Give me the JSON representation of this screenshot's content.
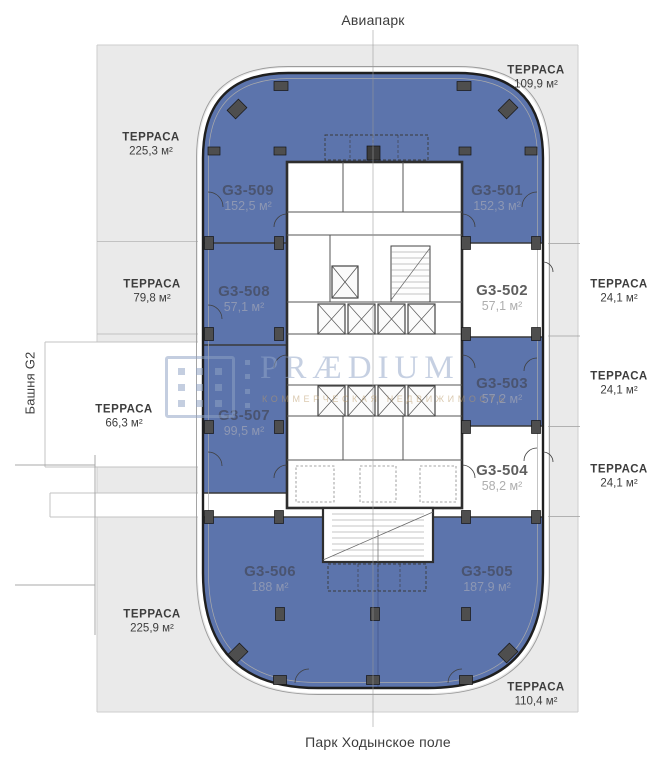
{
  "surroundings": {
    "top": "Авиапарк",
    "bottom": "Парк Ходынское поле",
    "left": "Башня G2"
  },
  "watermark": {
    "brand": "PRÆDIUM",
    "tagline": "КОММЕРЧЕСКАЯ НЕДВИЖИМОСТЬ"
  },
  "terraces": [
    {
      "name": "ТЕРРАСА",
      "area": "225,3 м²",
      "position": "top-left"
    },
    {
      "name": "ТЕРРАСА",
      "area": "109,9 м²",
      "position": "top-right"
    },
    {
      "name": "ТЕРРАСА",
      "area": "79,8 м²",
      "position": "left"
    },
    {
      "name": "ТЕРРАСА",
      "area": "66,3 м²",
      "position": "left-lower"
    },
    {
      "name": "ТЕРРАСА",
      "area": "24,1 м²",
      "position": "right-upper"
    },
    {
      "name": "ТЕРРАСА",
      "area": "24,1 м²",
      "position": "right-middle"
    },
    {
      "name": "ТЕРРАСА",
      "area": "24,1 м²",
      "position": "right-lower"
    },
    {
      "name": "ТЕРРАСА",
      "area": "225,9 м²",
      "position": "bottom-left"
    },
    {
      "name": "ТЕРРАСА",
      "area": "110,4 м²",
      "position": "bottom-right"
    }
  ],
  "units": [
    {
      "id": "G3-509",
      "area": "152,5 м²",
      "highlighted": true
    },
    {
      "id": "G3-501",
      "area": "152,3 м²",
      "highlighted": true
    },
    {
      "id": "G3-508",
      "area": "57,1 м²",
      "highlighted": true
    },
    {
      "id": "G3-502",
      "area": "57,1 м²",
      "highlighted": false
    },
    {
      "id": "G3-503",
      "area": "57,2 м²",
      "highlighted": true
    },
    {
      "id": "G3-507",
      "area": "99,5 м²",
      "highlighted": true
    },
    {
      "id": "G3-504",
      "area": "58,2 м²",
      "highlighted": false
    },
    {
      "id": "G3-506",
      "area": "188 м²",
      "highlighted": true
    },
    {
      "id": "G3-505",
      "area": "187,9 м²",
      "highlighted": true
    }
  ],
  "colors": {
    "unit_highlight": "#5c74ac",
    "plot": "#eaeaea",
    "wall": "#1f1f1f"
  }
}
